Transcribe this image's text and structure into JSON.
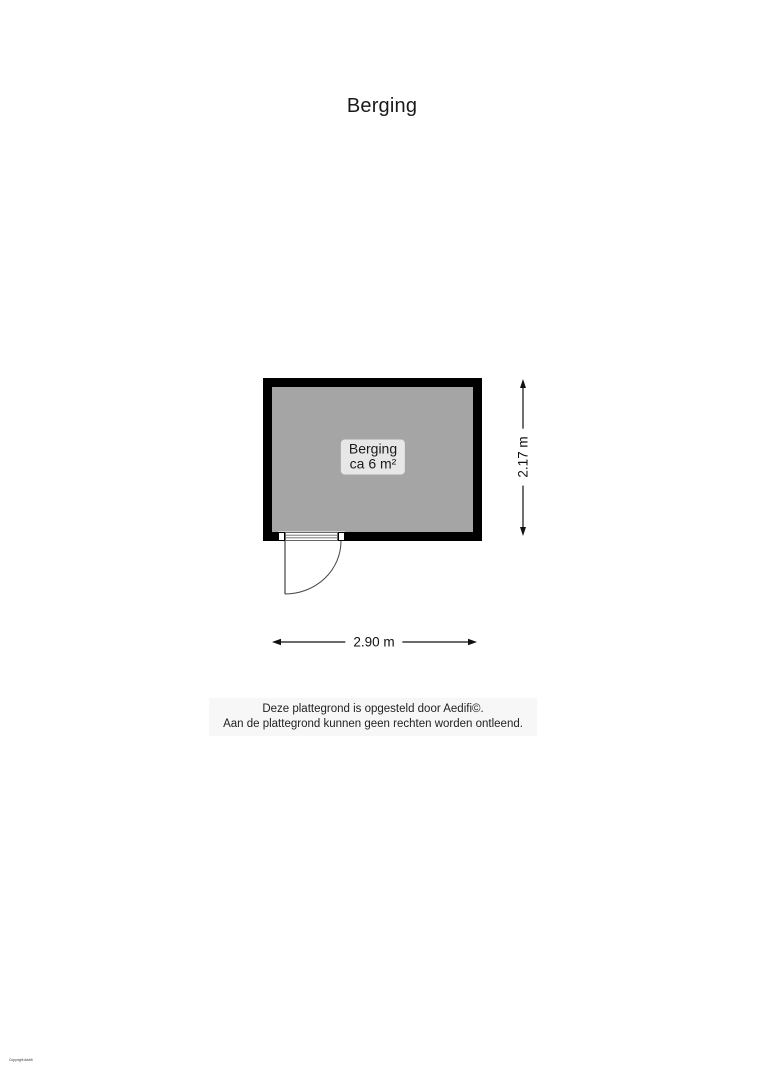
{
  "page": {
    "title": "Berging"
  },
  "floorplan": {
    "room": {
      "name": "Berging",
      "area": "ca 6 m²"
    },
    "dimensions": {
      "width_label": "2.90 m",
      "height_label": "2.17 m"
    },
    "colors": {
      "wall": "#000000",
      "floor": "#a5a5a5",
      "room_label_bg": "#e7e7e7",
      "dimension": "#111111",
      "door_line": "#444444"
    },
    "features": {
      "door": "single swing door, bottom-left, opens outward"
    }
  },
  "footer": {
    "disclaimer_line1": "Deze plattegrond is opgesteld door Aedifi©.",
    "disclaimer_line2": "Aan de plattegrond kunnen geen rechten worden ontleend."
  },
  "watermark": {
    "text": "Copyright Aedifi"
  }
}
